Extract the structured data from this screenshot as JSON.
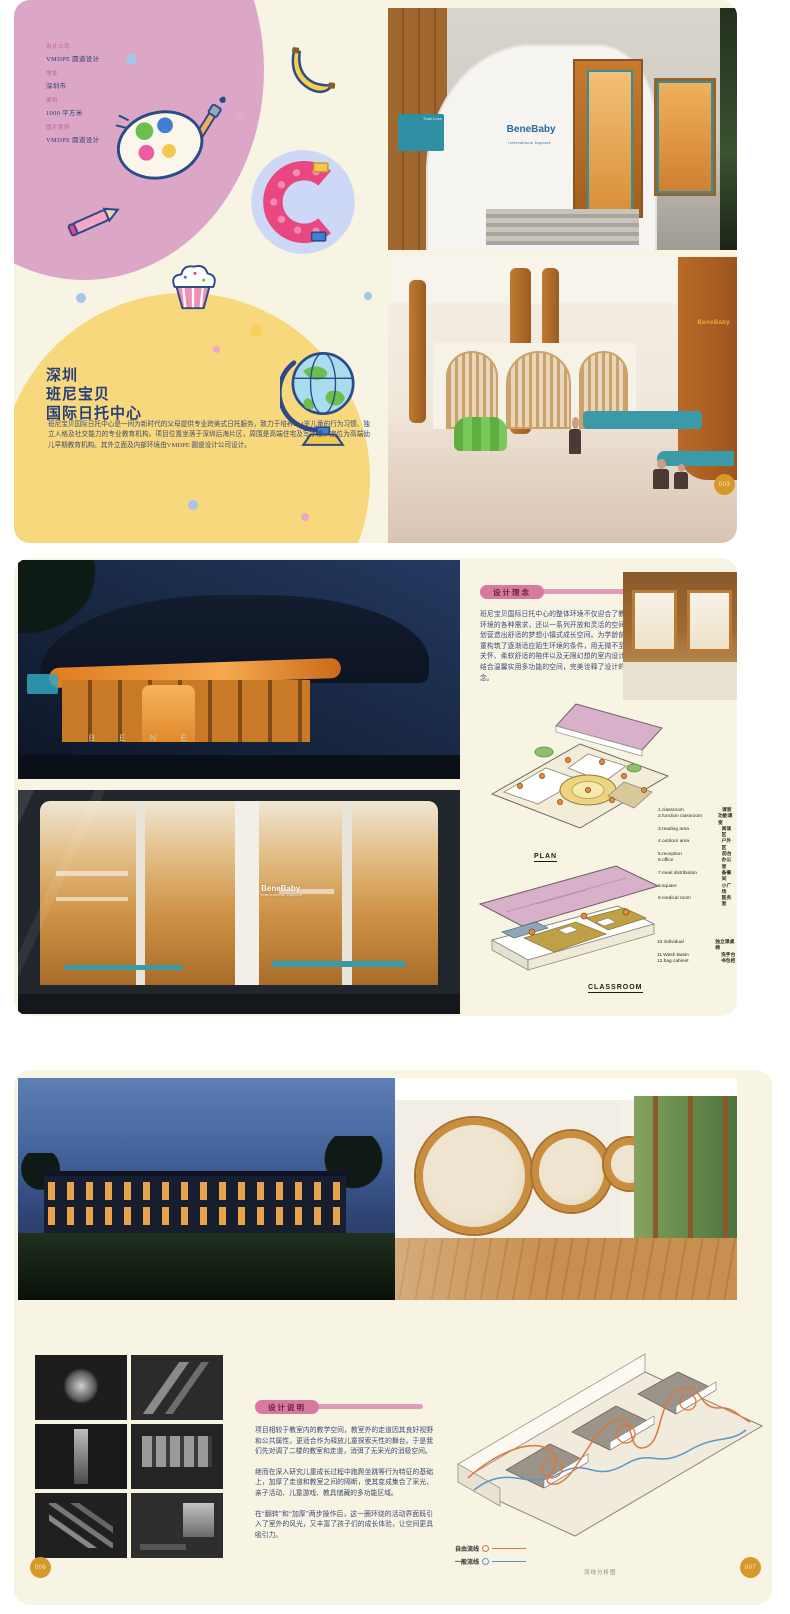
{
  "spread1": {
    "info": {
      "rows": [
        {
          "label": "设计公司",
          "value": "VMDPE 圆道设计"
        },
        {
          "label": "地址",
          "value": "深圳市"
        },
        {
          "label": "面积",
          "value": "1000 平方米"
        },
        {
          "label": "图片提供",
          "value": "VMDPE 圆道设计"
        }
      ]
    },
    "title": {
      "line1": "深圳",
      "line2": "班尼宝贝",
      "line3": "国际日托中心"
    },
    "intro": "班尼宝贝国际日托中心是一间为新时代的父母提供专业跨美式日托服务，致力于培养2~4岁儿童的行为习惯、独立人格及社交能力的专业教育机构。项目位置坐落于深圳后海片区，周围是高端住宅及写字楼，定位为高端幼儿早期教育机构。其外立面及内部环境由VMDPE 圆道设计公司设计。",
    "decorations": [
      "palette",
      "banana",
      "lego-letter-c",
      "pencil",
      "cupcake",
      "globe"
    ],
    "entrance_photo": {
      "sign_main": "BeneBaby",
      "sign_sub": "International Daycare",
      "plaque": "Than Love"
    },
    "interior_photo": {
      "wall_sign": "BeneBaby",
      "page_no": "003"
    }
  },
  "spread2": {
    "concept": {
      "badge": "设计理念",
      "body": "班尼宝贝国际日托中心的整体环境不仅迎合了教学环境的各种需求，还以一系列开放和灵活的空间规划营造出舒适的梦想小镇式成长空间。为学龄前儿童构筑了逐渐适应陌生环境的条件，用无微不至的关怀、柔软舒适的陪伴以及无限幻想的室内设计，结合温馨实用多功能的空间，完美诠释了设计的理念。"
    },
    "night_photo": {
      "glass_letters": "B E N E"
    },
    "storefront_photo": {
      "sign_main": "BeneBaby",
      "sign_sub": "International Daycare"
    },
    "plan": {
      "label": "PLAN",
      "legend": [
        {
          "en": "1.classroom",
          "zh": "课室"
        },
        {
          "en": "2.function classroom",
          "zh": "功能课室"
        },
        {
          "en": "3.reading area",
          "zh": "阅读区"
        },
        {
          "en": "4.outdoor area",
          "zh": "户外区"
        },
        {
          "en": "5.reception",
          "zh": "前台"
        },
        {
          "en": "6.office",
          "zh": "办公室"
        },
        {
          "en": "7.meal distribution",
          "zh": "备餐间"
        },
        {
          "en": "8.square",
          "zh": "小广场"
        },
        {
          "en": "9.medical room",
          "zh": "医务室"
        }
      ]
    },
    "classroom": {
      "label": "CLASSROOM",
      "legend": [
        {
          "en": "10.individual",
          "zh": "独立课桌椅"
        },
        {
          "en": "11.Wash Basin",
          "zh": "洗手台"
        },
        {
          "en": "12.bag cabinet",
          "zh": "书包柜"
        }
      ]
    }
  },
  "spread3": {
    "description": {
      "badge": "设计说明",
      "p1": "项目相较于教室内的教学空间，教室外的走道因其良好视野和公共属性，更适合作为释放儿童探索天性的舞台。于是我们先对调了二楼的教室和走道，消弭了无采光的消极空间。",
      "p2": "继而在深入研究儿童成长过程中跑爬坐跳等行为特征的基础上，加厚了走道和教室之间的隔断，使其变成集合了采光、亲子活动、儿童游戏、教具储藏的多功能区域。",
      "p3": "在“翻转”和“加厚”两步操作后，这一圈环绕的活动界面既引入了室外的风光，又丰富了孩子们的成长体验，让空间更具吸引力。"
    },
    "flow": {
      "legend_free": "自由流线",
      "legend_general": "一般流线",
      "caption": "流线分析图"
    },
    "page_left": "006",
    "page_right": "007"
  }
}
